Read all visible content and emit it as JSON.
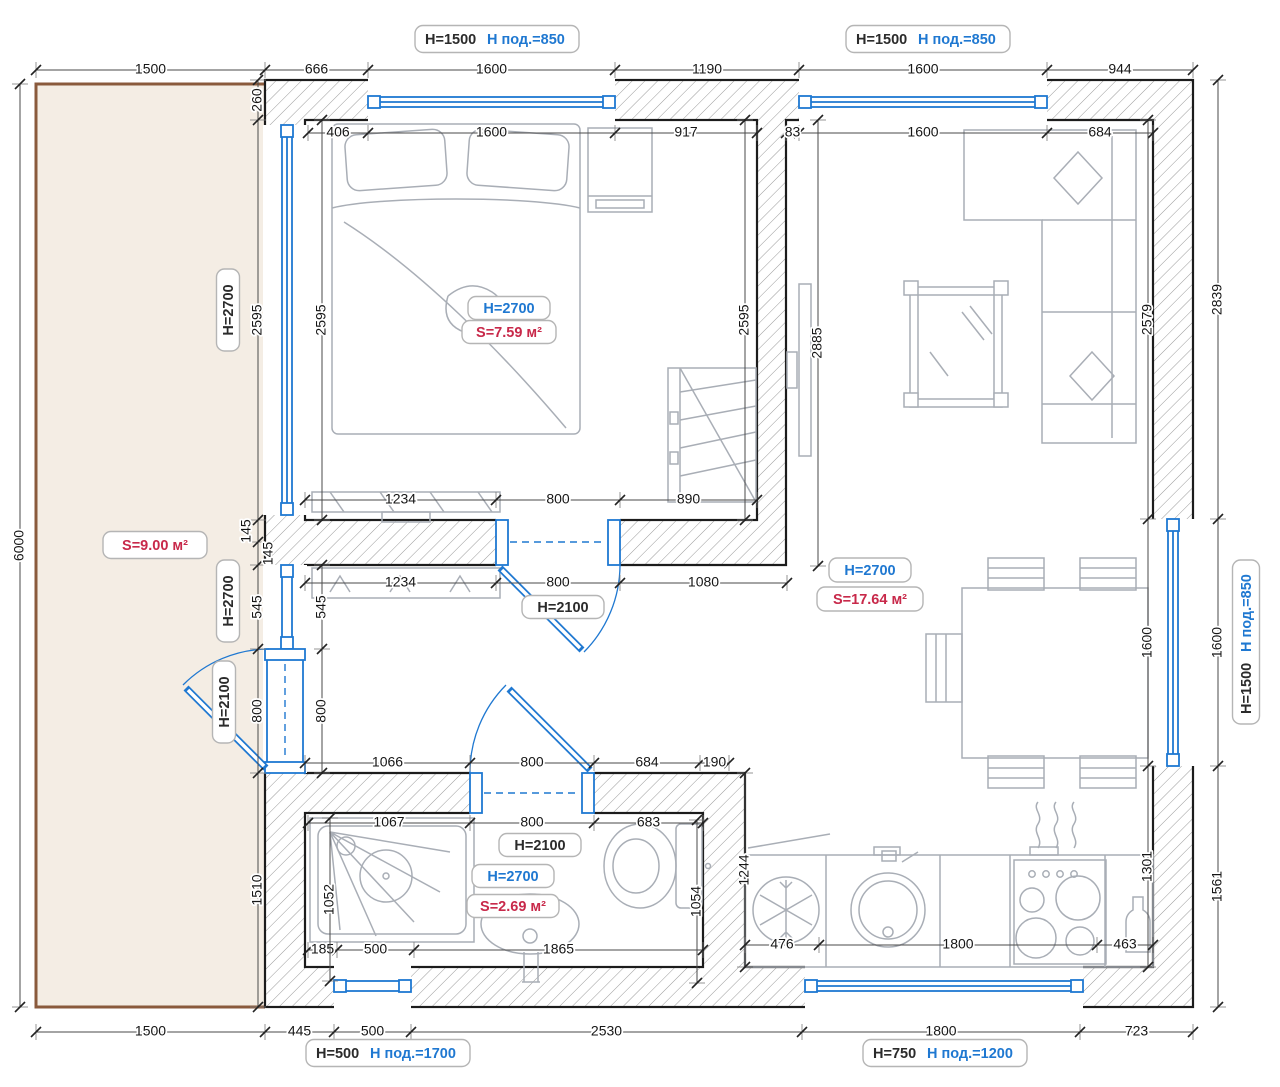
{
  "colors": {
    "blue": "#1f78d1",
    "red": "#c8294a",
    "wall_line": "#1c1c1c",
    "furniture": "#a9aeb6",
    "terrace_fill": "#f4ede4",
    "terrace_border": "#8a5a3c",
    "label_border": "#b5b5b5",
    "dim_text": "#161616"
  },
  "labels": {
    "window_top_bedroom": {
      "h": "H=1500",
      "sill": "Н под.=850"
    },
    "window_top_living": {
      "h": "H=1500",
      "sill": "Н под.=850"
    },
    "window_right": {
      "h": "H=1500",
      "sill": "Н под.=850"
    },
    "window_bath": {
      "h": "H=500",
      "sill": "Н под.=1700"
    },
    "window_kitchen": {
      "h": "H=750",
      "sill": "Н под.=1200"
    },
    "terrace": {
      "area": "S=9.00 м²"
    },
    "bedroom": {
      "height": "H=2700",
      "area": "S=7.59 м²"
    },
    "living": {
      "height": "H=2700",
      "area": "S=17.64 м²"
    },
    "bath": {
      "door": "H=2100",
      "height": "H=2700",
      "area": "S=2.69 м²"
    },
    "hall_door": "H=2100",
    "glazing_bedroom": "H=2700",
    "glazing_hall": "H=2700",
    "entry_door": "H=2100"
  },
  "dims": {
    "top_outer": [
      "1500",
      "666",
      "1600",
      "1190",
      "1600",
      "944"
    ],
    "top_inner_bedroom": [
      "406",
      "1600",
      "917"
    ],
    "top_inner_living": [
      "83",
      "1600",
      "684"
    ],
    "left_outer": [
      "260",
      "2595",
      "145",
      "145",
      "545",
      "800",
      "1510"
    ],
    "terrace_height": [
      "6000"
    ],
    "left_inner_top": [
      "2595"
    ],
    "left_inner_bottom": [
      "545",
      "800"
    ],
    "bedroom_right": [
      "2595"
    ],
    "bedroom_bottom": [
      "1234",
      "800",
      "890"
    ],
    "hall_top": [
      "1234",
      "800",
      "1080"
    ],
    "hall_bottom": [
      "1066",
      "800",
      "684",
      "190"
    ],
    "bath_top": [
      "1067",
      "800",
      "683"
    ],
    "bath_bottom": [
      "185",
      "500",
      "1865"
    ],
    "shower_height": [
      "1052"
    ],
    "toilet_height": [
      "1054"
    ],
    "bath_right_height": [
      "1244"
    ],
    "tv_wall": [
      "2885"
    ],
    "living_right_inner": [
      "2579",
      "1600",
      "1301"
    ],
    "right_outer": [
      "2839",
      "1600",
      "1561"
    ],
    "kitchen_row": [
      "476",
      "1800",
      "463"
    ],
    "bottom_outer": [
      "1500",
      "445",
      "500",
      "2530",
      "1800",
      "723"
    ]
  }
}
